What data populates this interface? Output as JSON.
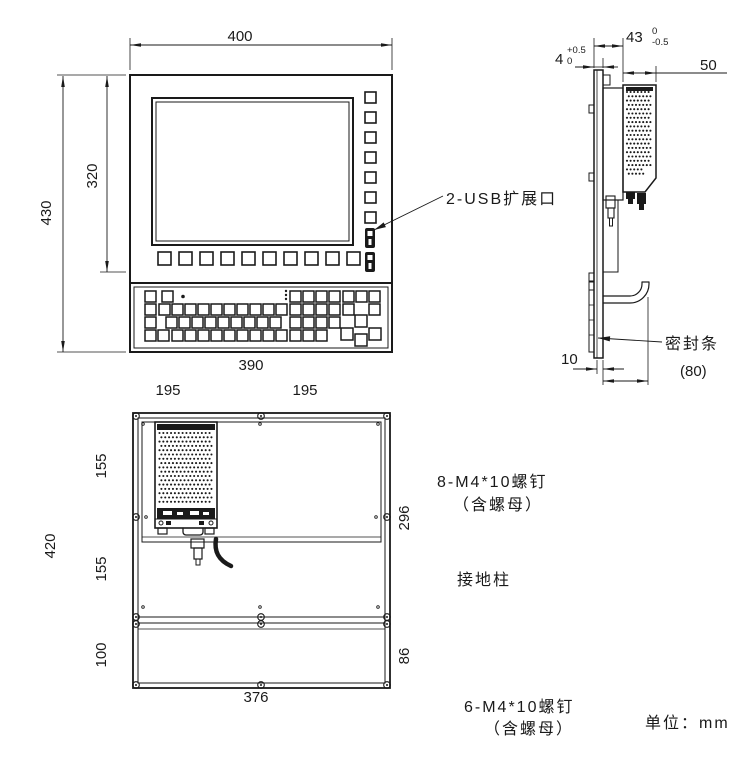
{
  "units_note": "单位：mm",
  "front_view": {
    "dim_width": "400",
    "dim_height": "430",
    "dim_screen_height": "320",
    "usb_label": "2-USB扩展口"
  },
  "side_view": {
    "dim_depth": "43",
    "dim_depth_tol_up": "0",
    "dim_depth_tol_dn": "-0.5",
    "dim_panel": "4",
    "dim_panel_tol_up": "+0.5",
    "dim_panel_tol_dn": "0",
    "dim_box": "50",
    "dim_strip": "10",
    "dim_ref": "(80)",
    "seal_label": "密封条"
  },
  "rear_view": {
    "dim_width": "390",
    "dim_left_half": "195",
    "dim_right_half": "195",
    "dim_height": "420",
    "dim_seg_top": "155",
    "dim_seg_mid": "155",
    "dim_seg_bottom": "100",
    "dim_plate_height": "296",
    "dim_lower_height": "86",
    "dim_bottom_width": "376",
    "screws_top_label": "8-M4*10螺钉",
    "screws_top_note": "（含螺母）",
    "ground_label": "接地柱",
    "screws_bottom_label": "6-M4*10螺钉",
    "screws_bottom_note": "（含螺母）"
  }
}
